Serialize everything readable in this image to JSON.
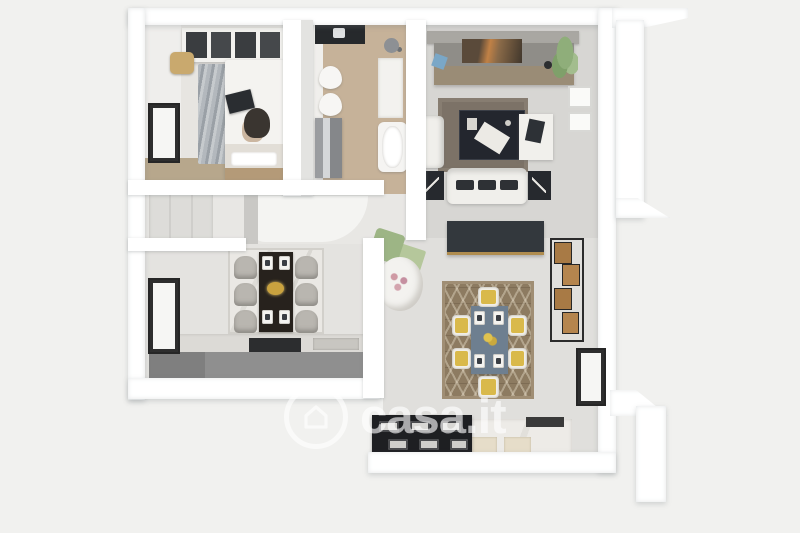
{
  "watermark": {
    "brand": "casa.it",
    "icon": "house-circle-icon"
  },
  "scene": {
    "type": "3d-floorplan-top-down-render",
    "rooms": [
      "bedroom",
      "bathroom",
      "living-room-with-kitchenette",
      "hallway",
      "kitchen-dining",
      "dining-area",
      "balcony-right",
      "balcony-bottom-right"
    ]
  },
  "colors": {
    "background": "#f1f1ef",
    "wall": "#ffffff",
    "wall_shadow": "#d7d9db",
    "floor_living": "#d7d6d3",
    "floor_dining": "#e0dfdc",
    "floor_kitchen": "#e4e3e0",
    "floor_hall": "#e8e7e4",
    "floor_wood": "#c6b299",
    "bedroom_wood": "#b7a78c",
    "rug_living": "#7c7267",
    "rug_dining": "#8d7b61",
    "rug_dining_line": "#a6957d",
    "sofa_white": "#f0efeb",
    "dark_furniture": "#23262e",
    "tv_panel": "#33383d",
    "counter_gray": "#8f8f8f",
    "counter_top": "#dcdad6",
    "marble": "#edebe7",
    "hob_black": "#1e1f22",
    "table_dining": "#6e7f90",
    "chair_yellow": "#d9b94b",
    "wood_box": "#a87a45",
    "plant_green": "#8fae7a",
    "watermark_white": "#ffffff"
  }
}
